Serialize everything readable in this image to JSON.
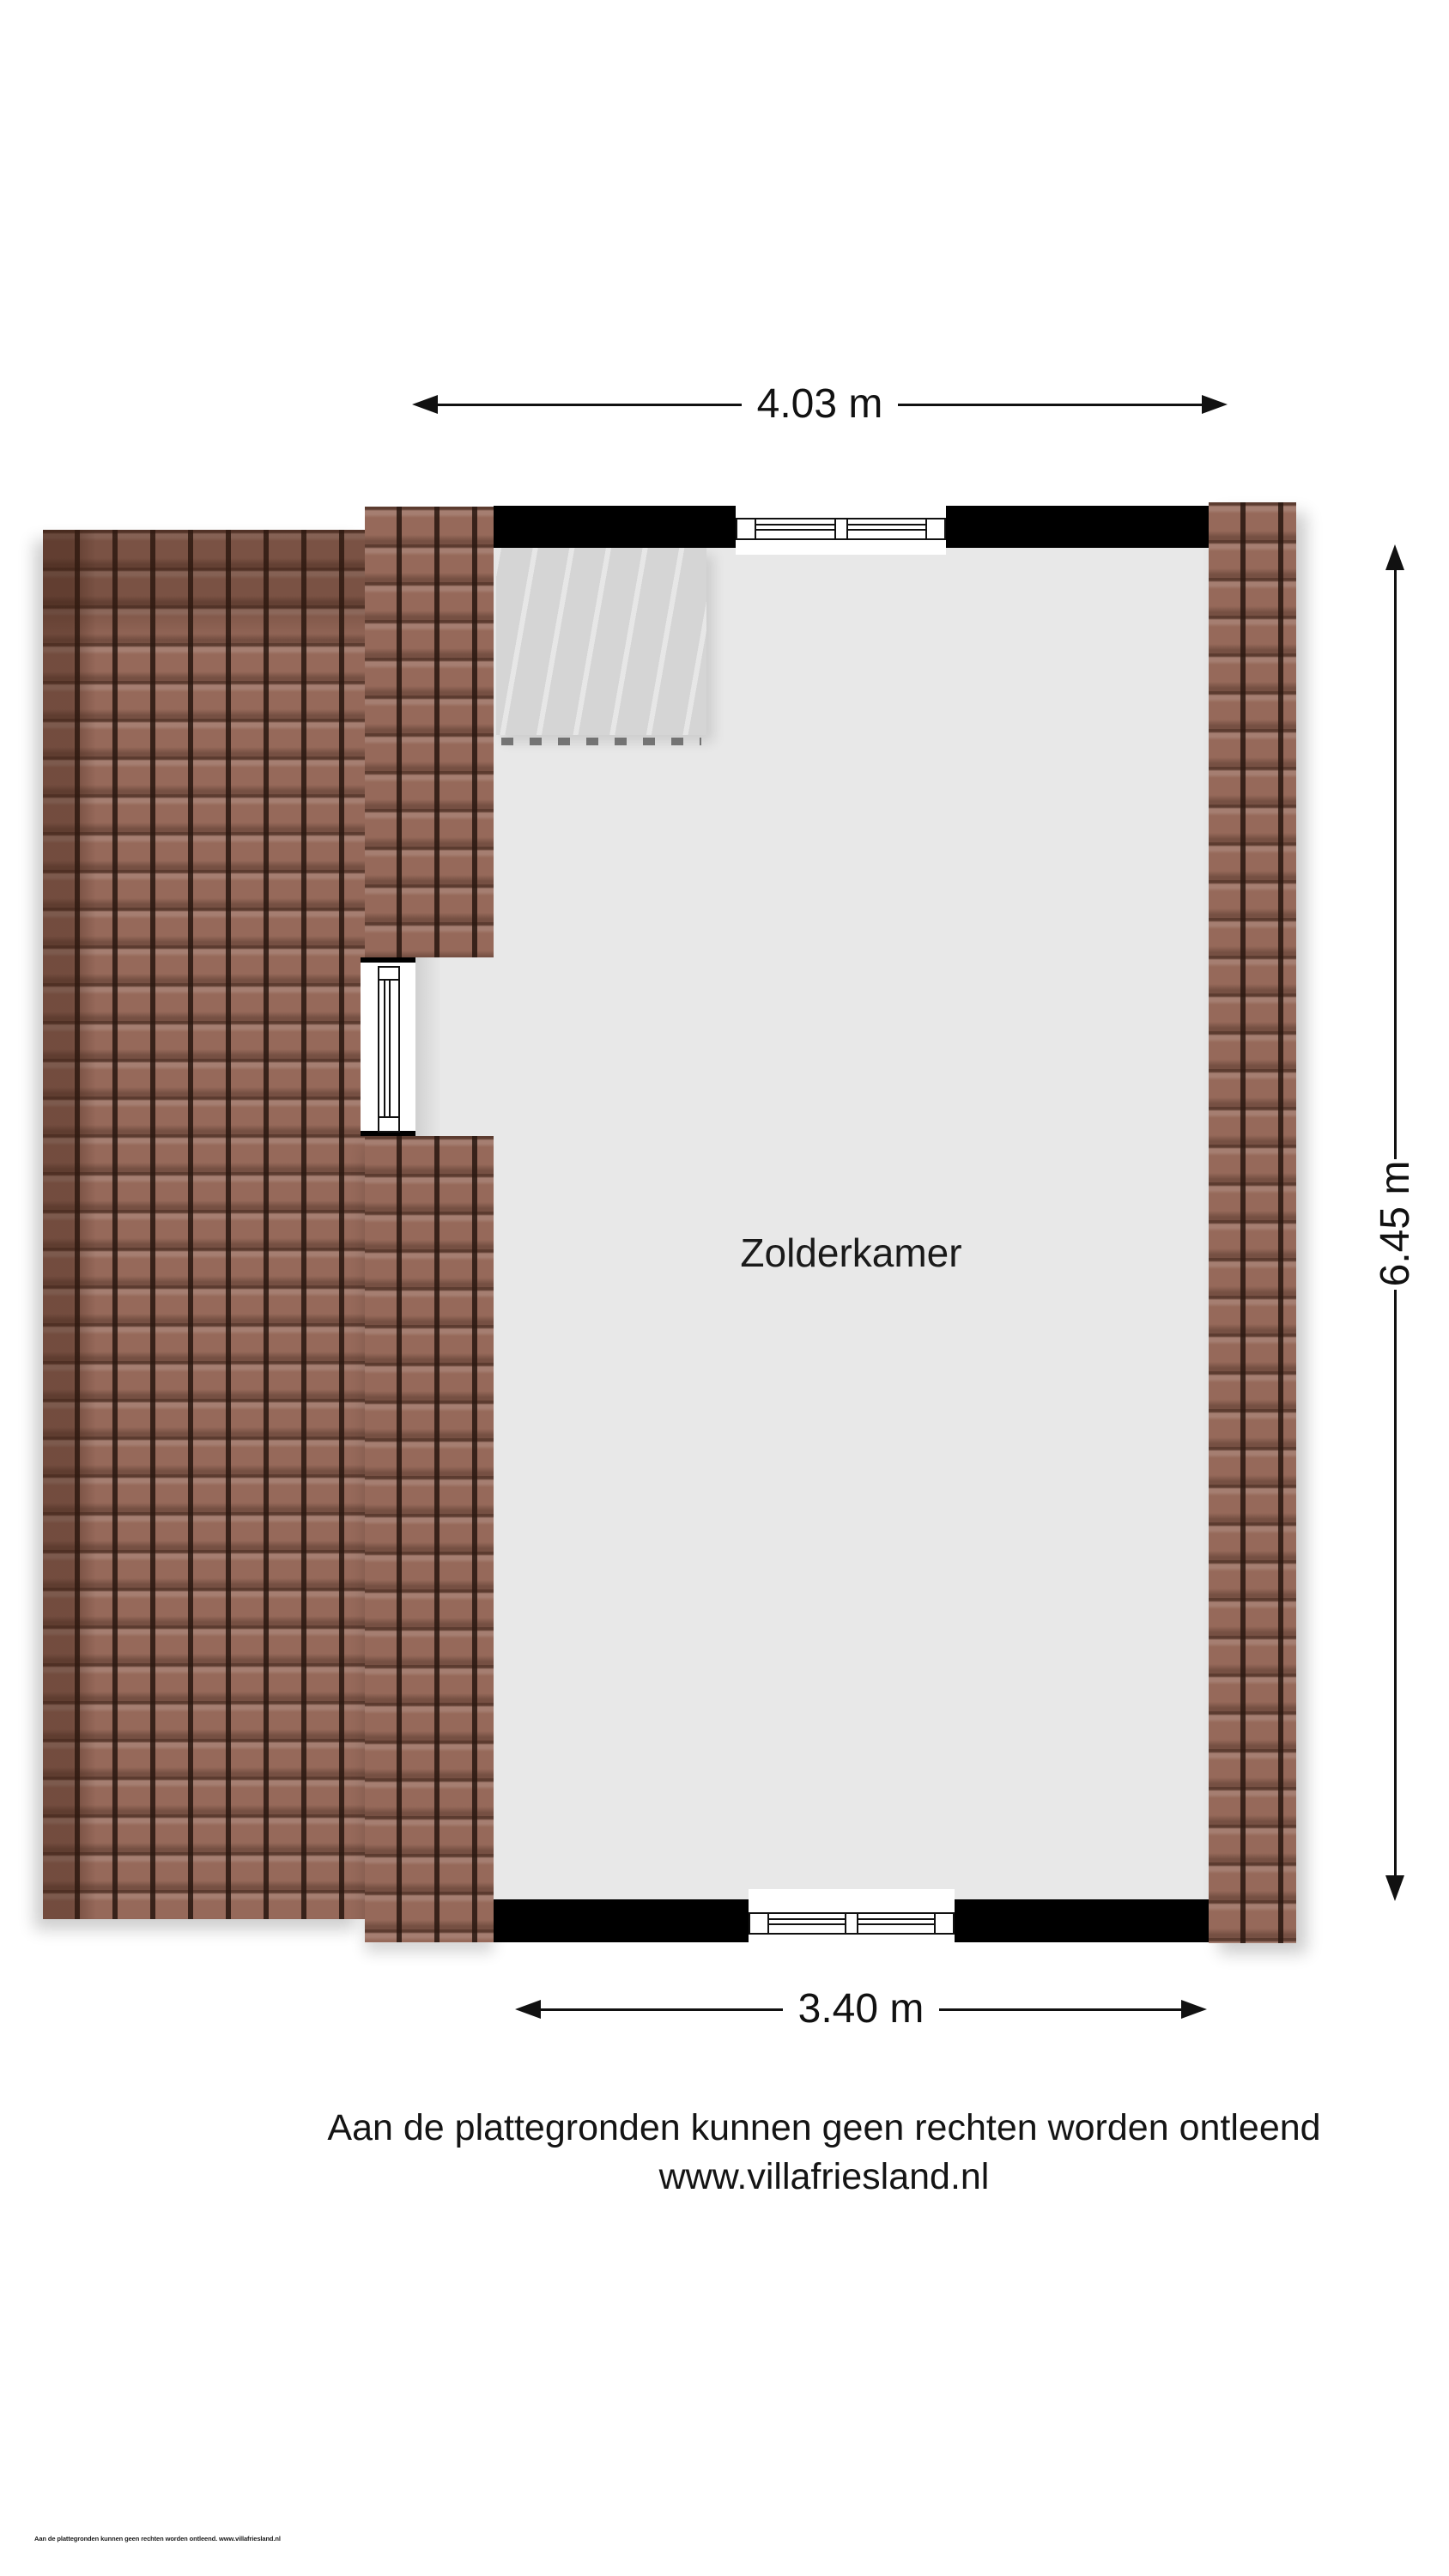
{
  "floorplan": {
    "room_label": "Zolderkamer",
    "dimensions": {
      "top": "4.03 m",
      "right": "6.45 m",
      "bottom": "3.40 m"
    },
    "icons": {
      "dimension_arrow": "solid-triangle-arrowhead"
    },
    "colors": {
      "roof_tile": "#96695a",
      "roof_tile_line": "#2e1d16",
      "wall": "#000000",
      "floor": "#e8e8e8",
      "stairs": "#d5d5d5",
      "window": "#ffffff"
    }
  },
  "footer": {
    "disclaimer_line1": "Aan de plattegronden kunnen geen rechten worden ontleend",
    "disclaimer_line2": "www.villafriesland.nl",
    "small_print": "Aan de plattegronden kunnen geen rechten worden ontleend. www.villafriesland.nl"
  }
}
